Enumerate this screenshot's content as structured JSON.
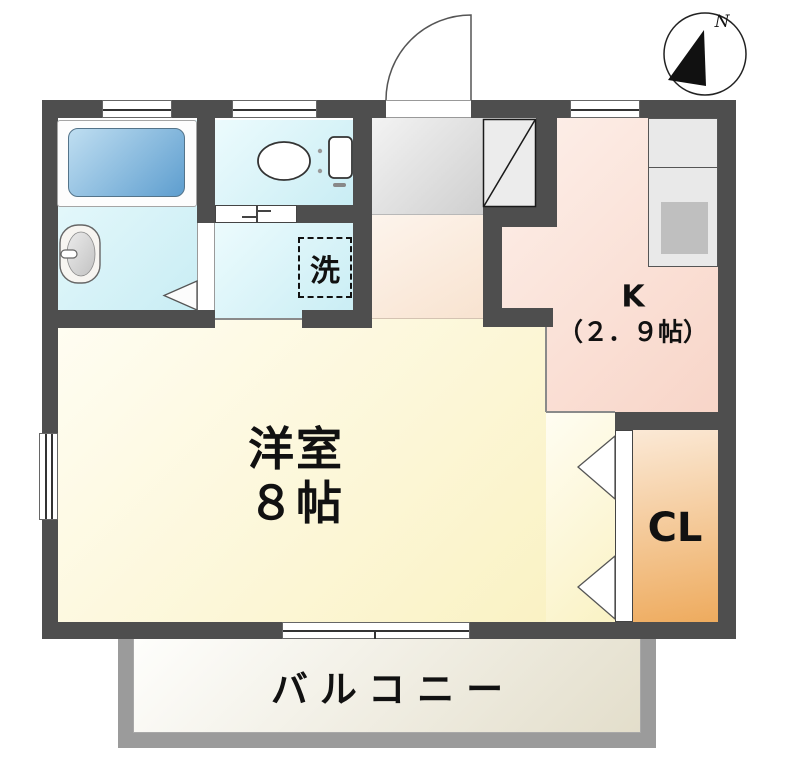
{
  "plan": {
    "compass_label": "N",
    "rooms": {
      "western_room": {
        "line1": "洋室",
        "line2": "８帖"
      },
      "kitchen": {
        "line1": "K",
        "line2": "（２．９帖）"
      },
      "closet": {
        "label": "CL"
      },
      "balcony": {
        "label": "バルコニー"
      },
      "laundry_pad": {
        "label": "洗"
      }
    },
    "fixtures": [
      "bathtub",
      "washbasin",
      "toilet",
      "shoe-cabinet",
      "kitchen-counter",
      "stove",
      "washing-machine-space",
      "entrance-door",
      "closet-bifold-door"
    ],
    "colors": {
      "wall": "#4e4e4e",
      "wet_area_floor": "#c9edf4",
      "kitchen_floor": "#f8d5c8",
      "room_floor": "#faf2c4",
      "closet_floor": "#eeab5e",
      "entrance_floor": "#c6c6c6",
      "hall_floor": "#f8e3d0",
      "balcony_floor": "#e3decb",
      "balcony_border": "#9b9b9b",
      "bathtub": "#5e9ecf"
    }
  }
}
